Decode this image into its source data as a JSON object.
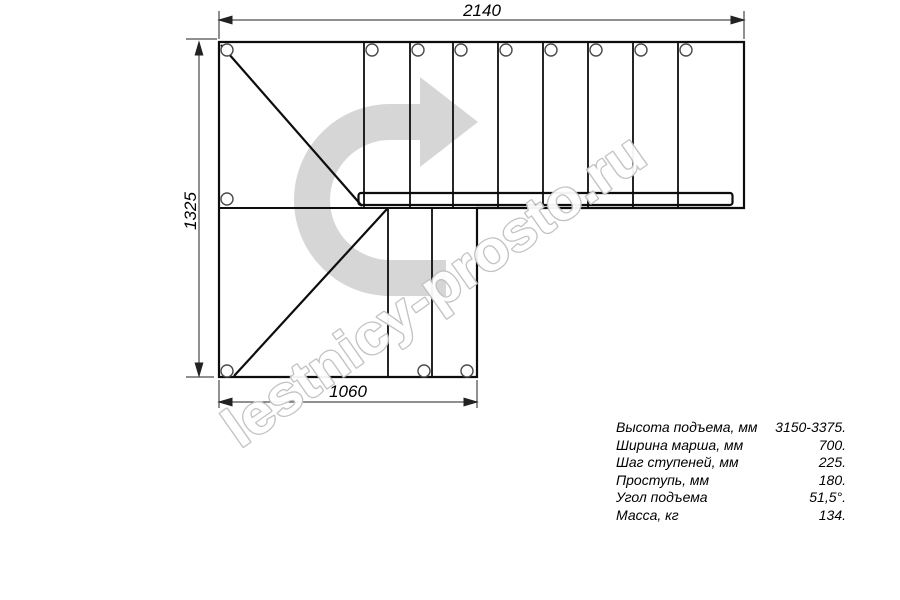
{
  "drawing": {
    "dim_top": "2140",
    "dim_left": "1325",
    "dim_bottom": "1060",
    "watermark": "lestnicy-prosto.ru",
    "colors": {
      "line": "#0d0d0d",
      "dim_line": "#222222",
      "hole_stroke": "#4a4a4a",
      "arrow_fill": "#d6d6d6",
      "watermark_stroke": "#c0c0c0"
    }
  },
  "specs": {
    "rows": [
      {
        "label": "Высота подъема, мм",
        "value": "3150-3375."
      },
      {
        "label": "Ширина марша, мм",
        "value": "700."
      },
      {
        "label": "Шаг ступеней, мм",
        "value": "225."
      },
      {
        "label": "Проступь, мм",
        "value": "180."
      },
      {
        "label": "Угол подъема",
        "value": "51,5°."
      },
      {
        "label": "Масса, кг",
        "value": "134."
      }
    ]
  }
}
